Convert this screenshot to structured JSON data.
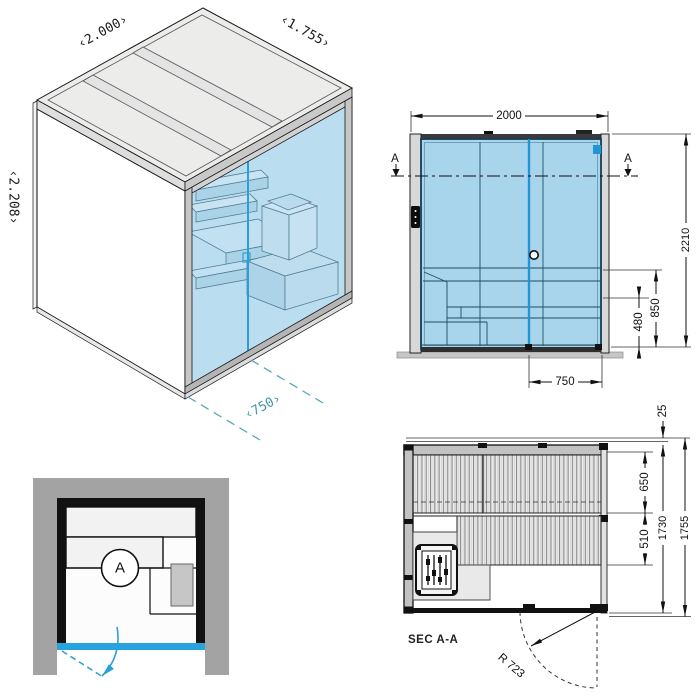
{
  "isometric": {
    "width_label": "‹2.000›",
    "depth_label": "‹1.755›",
    "height_label": "‹2.208›",
    "door_width_label": "‹750›"
  },
  "elevation": {
    "width": "2000",
    "height": "2210",
    "bench_height": "850",
    "step_height": "480",
    "door_width": "750",
    "section_marker_left": "A",
    "section_marker_right": "A"
  },
  "floor_plan": {
    "section_marker": "A"
  },
  "section": {
    "label": "SEC A-A",
    "door_swing_radius": "R 723",
    "roof_overhang": "25",
    "upper_bench_depth": "650",
    "lower_bench_depth": "510",
    "inner_depth": "1730",
    "outer_depth": "1755"
  },
  "colors": {
    "glass_blue": "#a9d5ec",
    "door_blue": "#2196d4",
    "teal_annotation": "#3e95a6",
    "niche_gray": "#a3a3a3"
  }
}
